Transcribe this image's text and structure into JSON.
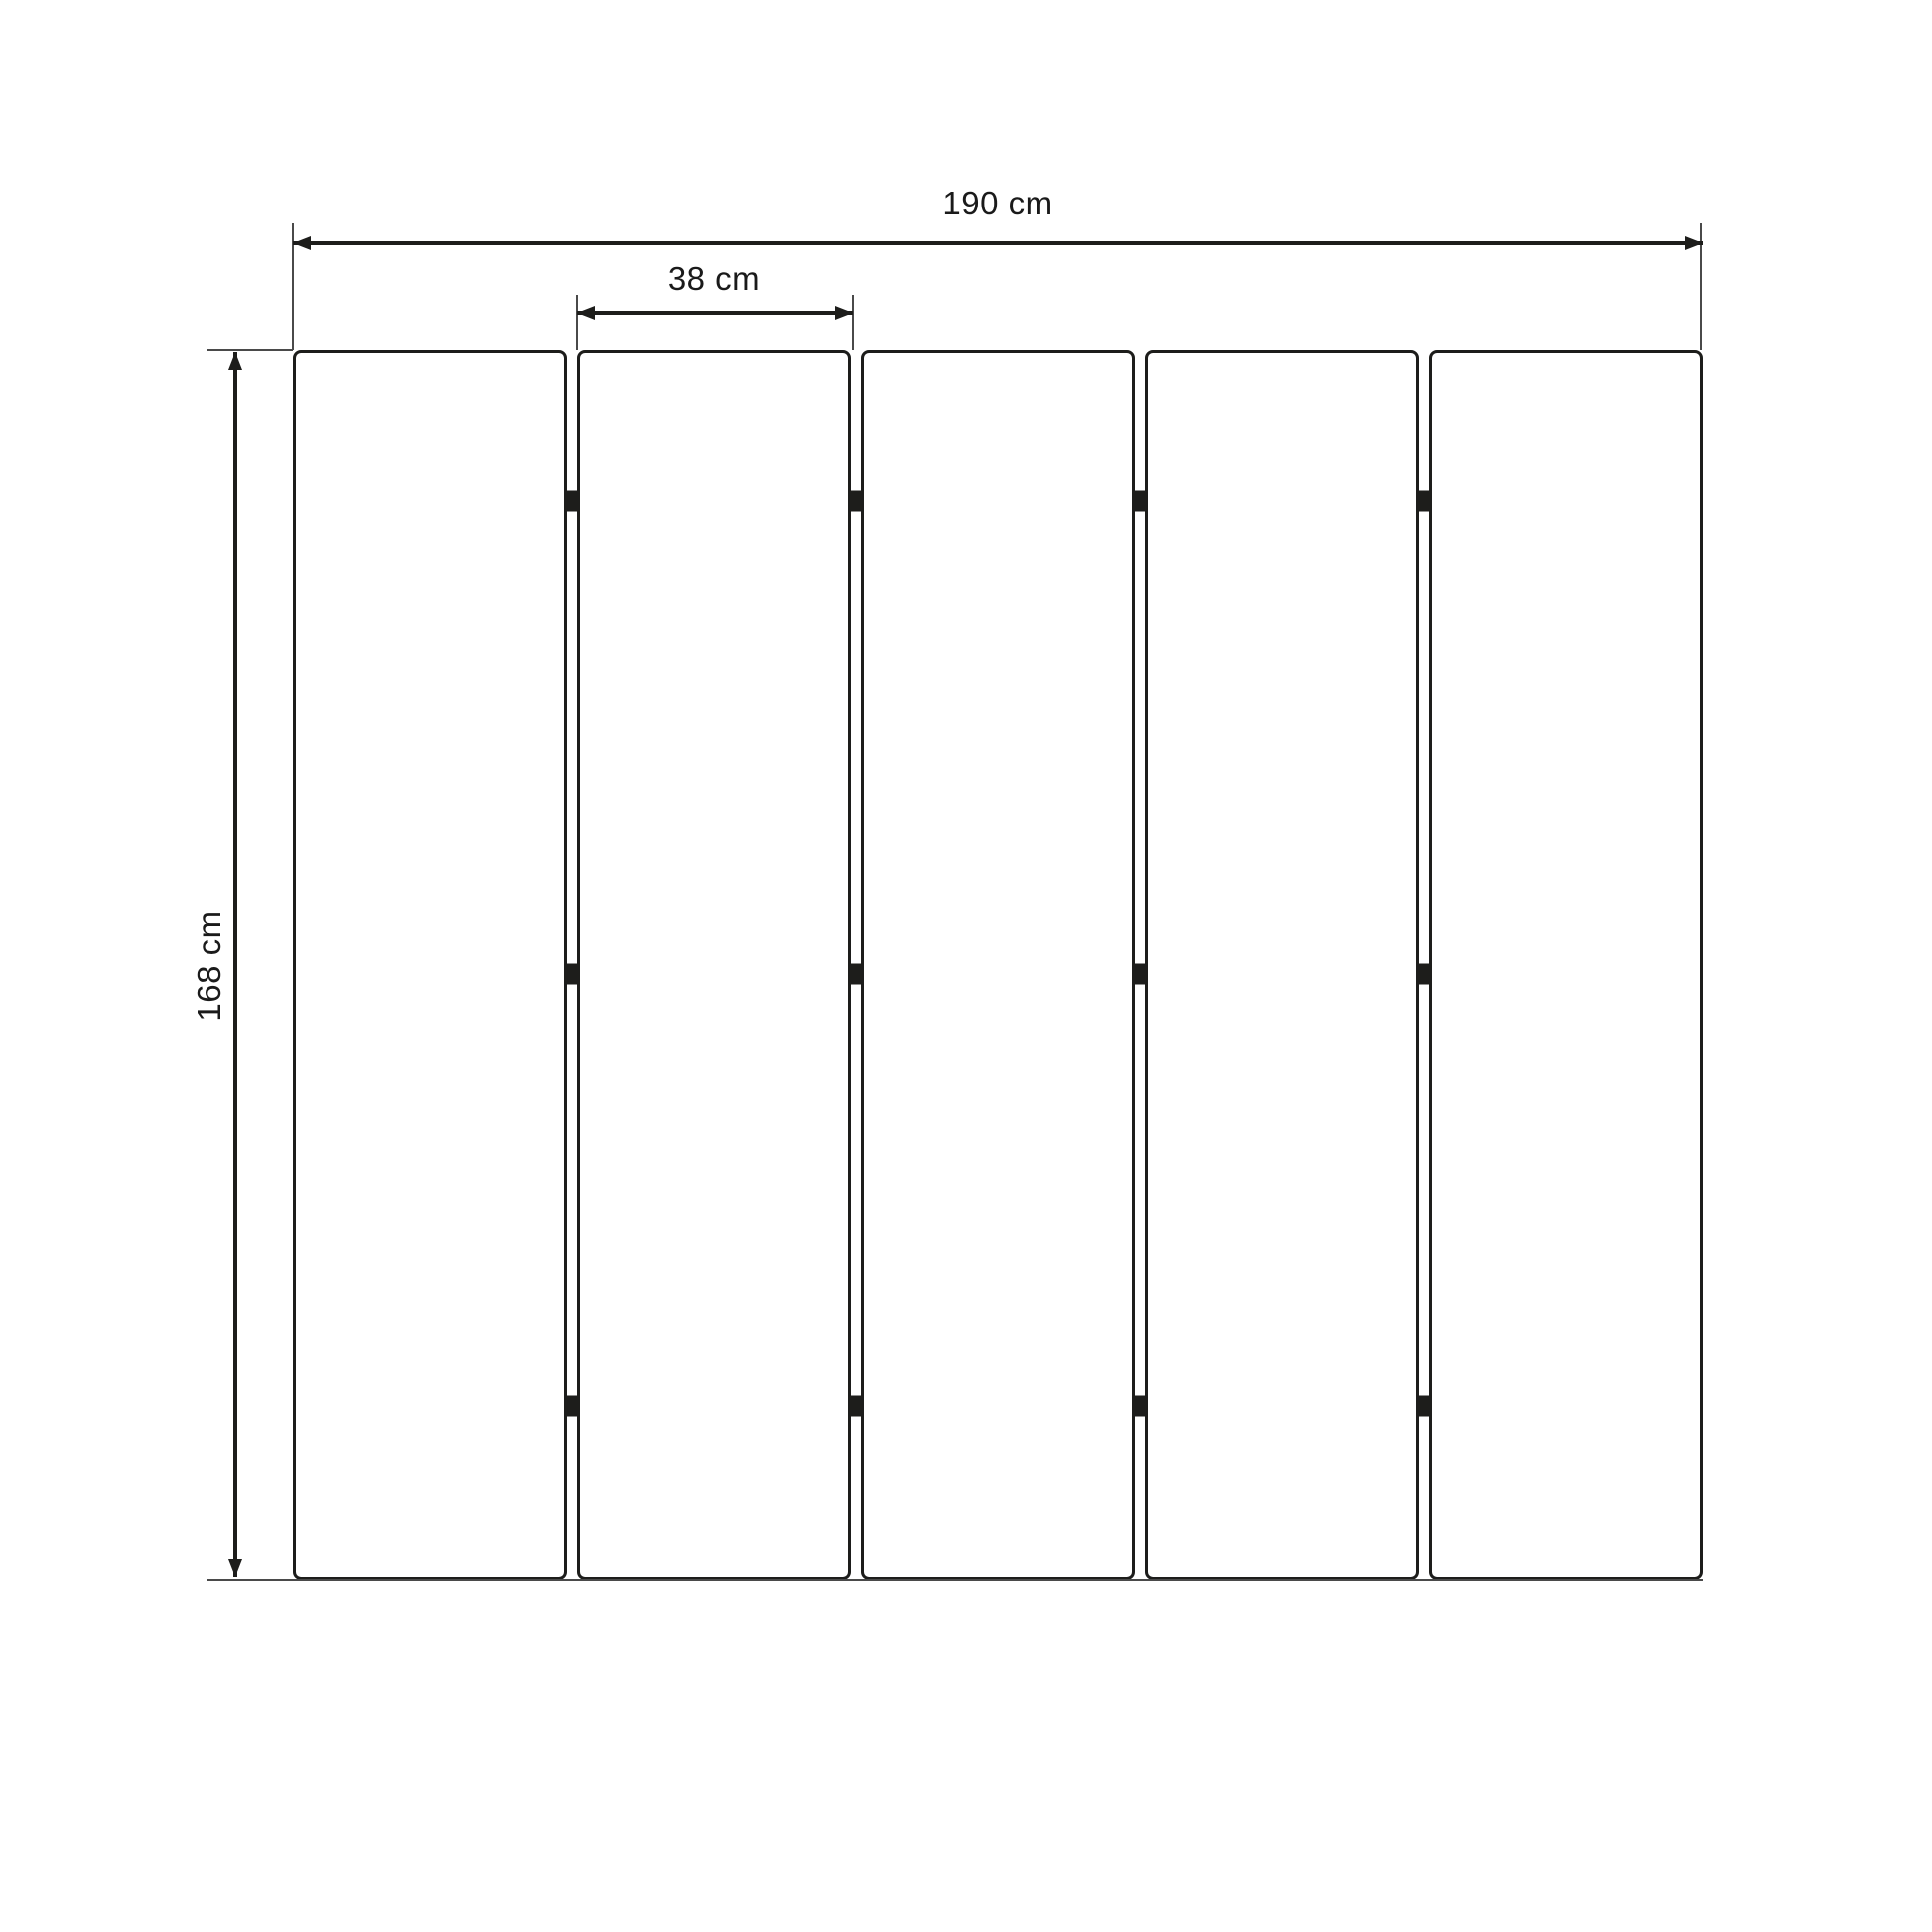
{
  "diagram": {
    "type": "technical-dimension-drawing",
    "panel_count": 5,
    "gap_count": 4,
    "hinges_per_gap": 3,
    "dimensions": {
      "total_width": "190 cm",
      "panel_width": "38 cm",
      "height": "168 cm"
    },
    "colors": {
      "line": "#1d1d1b",
      "panel_fill": "#ffffff",
      "background": "#ffffff"
    }
  }
}
